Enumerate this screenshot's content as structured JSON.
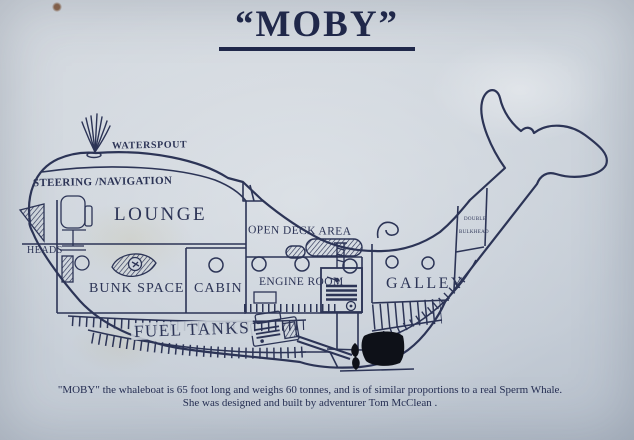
{
  "title": "“MOBY”",
  "labels": {
    "waterspout": "WATERSPOUT",
    "steering_navigation": "STEERING /NAVIGATION",
    "lounge": "LOUNGE",
    "heads": "HEADS",
    "bunk_space": "BUNK SPACE",
    "cabin": "CABIN",
    "open_deck_area": "OPEN DECK AREA",
    "engine_room": "ENGINE ROOM",
    "galley": "GALLEY",
    "double_bulkhead_top": "DOUBLE",
    "double_bulkhead_bottom": "BULKHEAD",
    "fuel_tanks": "FUEL TANKS"
  },
  "caption": {
    "line1": "\"MOBY\" the whaleboat is 65 foot long and weighs 60 tonnes, and is of similar proportions to a real Sperm Whale.",
    "line2": "She was designed and built by adventurer Tom McClean ."
  },
  "facts": {
    "length": "65 foot",
    "weight": "60 tonnes",
    "builder": "Tom McClean"
  },
  "colors": {
    "paper": "#ccd3db",
    "ink": "#2c3456",
    "fin_black": "#0e1118"
  }
}
